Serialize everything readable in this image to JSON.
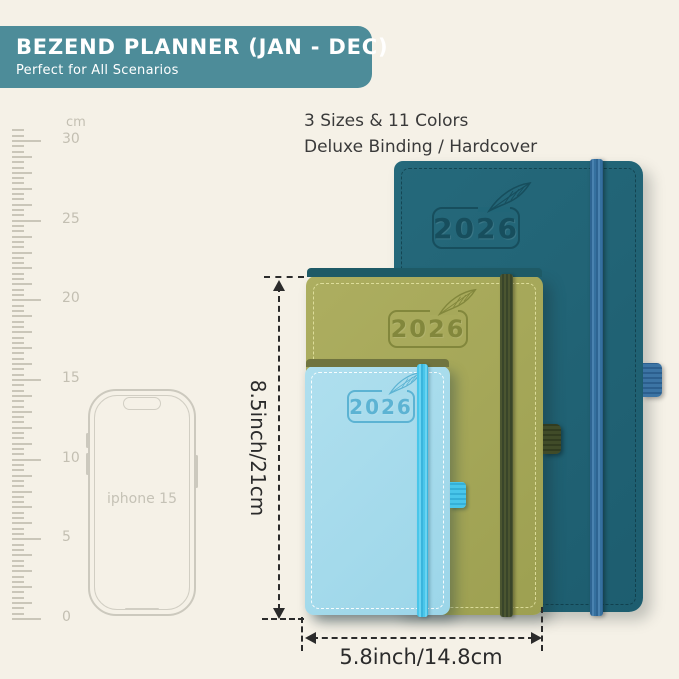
{
  "banner": {
    "title": "BEZEND PLANNER (JAN - DEC)",
    "subtitle": "Perfect for All Scenarios",
    "bg_color": "#4d8c99"
  },
  "features": {
    "line1": "3 Sizes & 11 Colors",
    "line2": "Deluxe Binding / Hardcover"
  },
  "ruler": {
    "unit": "cm",
    "labels": [
      "30",
      "25",
      "20",
      "15",
      "10",
      "5",
      "0"
    ]
  },
  "phone": {
    "label": "iphone 15"
  },
  "planners": {
    "large": {
      "year": "2026",
      "body_color": "#216678",
      "band_color": "#3b73a3"
    },
    "medium": {
      "year": "2026",
      "body_color": "#a6a85a",
      "band_color": "#46512c"
    },
    "small": {
      "year": "2026",
      "body_color": "#a7dcec",
      "band_color": "#49c6ea"
    }
  },
  "dimensions": {
    "height_label": "8.5inch/21cm",
    "width_label": "5.8inch/14.8cm"
  }
}
